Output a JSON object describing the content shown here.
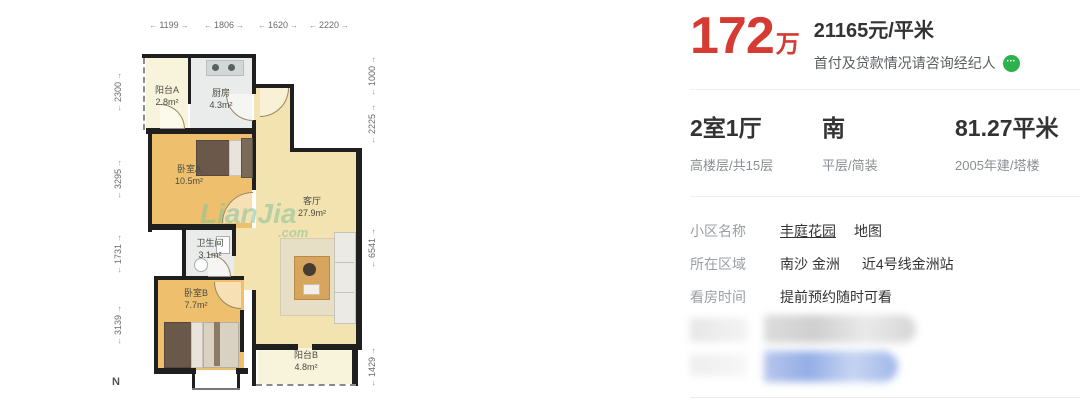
{
  "floorplan": {
    "dims_top": [
      "1199",
      "1806",
      "1620",
      "2220"
    ],
    "dims_left": [
      "2300",
      "3295",
      "1731",
      "3139"
    ],
    "dims_right": [
      "1000",
      "2225",
      "6541",
      "1429"
    ],
    "rooms": [
      {
        "name": "阳台A",
        "area": "2.8m²"
      },
      {
        "name": "厨房",
        "area": "4.3m²"
      },
      {
        "name": "卧室A",
        "area": "10.5m²"
      },
      {
        "name": "客厅",
        "area": "27.9m²"
      },
      {
        "name": "卫生间",
        "area": "3.1m²"
      },
      {
        "name": "卧室B",
        "area": "7.7m²"
      },
      {
        "name": "阳台B",
        "area": "4.8m²"
      }
    ],
    "compass": "N",
    "watermark": {
      "line1": "LianJia",
      "line2": ".com"
    }
  },
  "price": {
    "amount": "172",
    "unit": "万",
    "per_sqm": "21165元/平米",
    "consult": "首付及贷款情况请咨询经纪人"
  },
  "summary": {
    "rooms": "2室1厅",
    "rooms_sub": "高楼层/共15层",
    "orientation": "南",
    "orientation_sub": "平层/简装",
    "area": "81.27平米",
    "area_sub": "2005年建/塔楼"
  },
  "info": {
    "rows": [
      {
        "label": "小区名称",
        "value": "丰庭花园",
        "extra": "地图"
      },
      {
        "label": "所在区域",
        "value": "南沙 金洲",
        "extra": "近4号线金洲站"
      },
      {
        "label": "看房时间",
        "value": "提前预约随时可看",
        "extra": ""
      }
    ]
  },
  "colors": {
    "accent_red": "#d53b33",
    "icon_green": "#2bb24c",
    "wall_black": "#1f1f1f",
    "bedroom_floor": "#eec06d",
    "living_floor": "#f3e3b0",
    "balcony_floor": "#f8f4dc",
    "wet_floor": "#eaecec"
  }
}
